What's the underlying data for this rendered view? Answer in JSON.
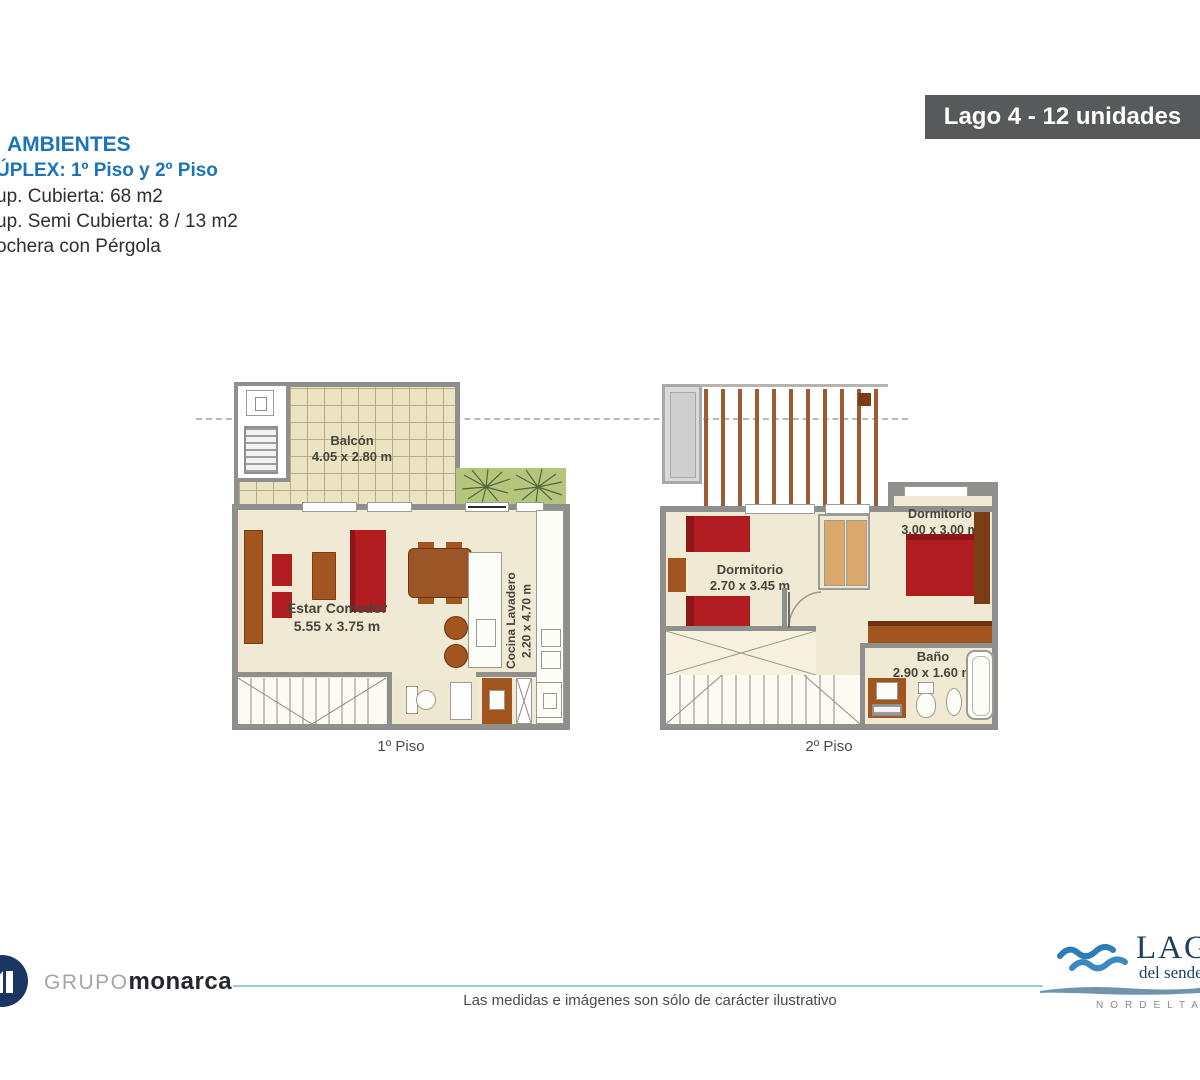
{
  "banner": {
    "label": "Lago 4 - 12 unidades"
  },
  "info": {
    "line1": "AMBIENTES",
    "line2": "ÚPLEX: 1º Piso y 2º Piso",
    "line3": "up. Cubierta: 68 m2",
    "line4": "up. Semi Cubierta: 8 / 13 m2",
    "line5": "ochera con Pérgola"
  },
  "plan1": {
    "caption": "1º Piso",
    "rooms": [
      {
        "name": "Balcón",
        "dims": "4.05 x 2.80 m"
      },
      {
        "name": "Estar Comedor",
        "dims": "5.55 x 3.75 m"
      },
      {
        "name": "Cocina Lavadero",
        "dims": "2.20 x 4.70 m"
      }
    ]
  },
  "plan2": {
    "caption": "2º Piso",
    "rooms": [
      {
        "name": "Dormitorio",
        "dims": "2.70 x 3.45 m"
      },
      {
        "name": "Dormitorio",
        "dims": "3.00 x 3.00 m"
      },
      {
        "name": "Baño",
        "dims": "2.90 x 1.60 m"
      }
    ]
  },
  "footer": {
    "brand_prefix": "GRUPO",
    "brand_name": "monarca",
    "disclaimer": "Las medidas e imágenes son sólo de carácter ilustrativo",
    "lago_title": "LAGO",
    "lago_subtitle": "del sendero",
    "lago_city": "NORDELTA"
  },
  "colors": {
    "accent_blue": "#1b74b8",
    "banner_bg": "#58595b",
    "wall_gray": "#8f8f8d",
    "floor_beige": "#f0e9d3",
    "furniture_red": "#b01c20",
    "furniture_wood": "#a3551f",
    "grass_green": "#b5c67c",
    "logo_navy": "#1d3f66"
  }
}
